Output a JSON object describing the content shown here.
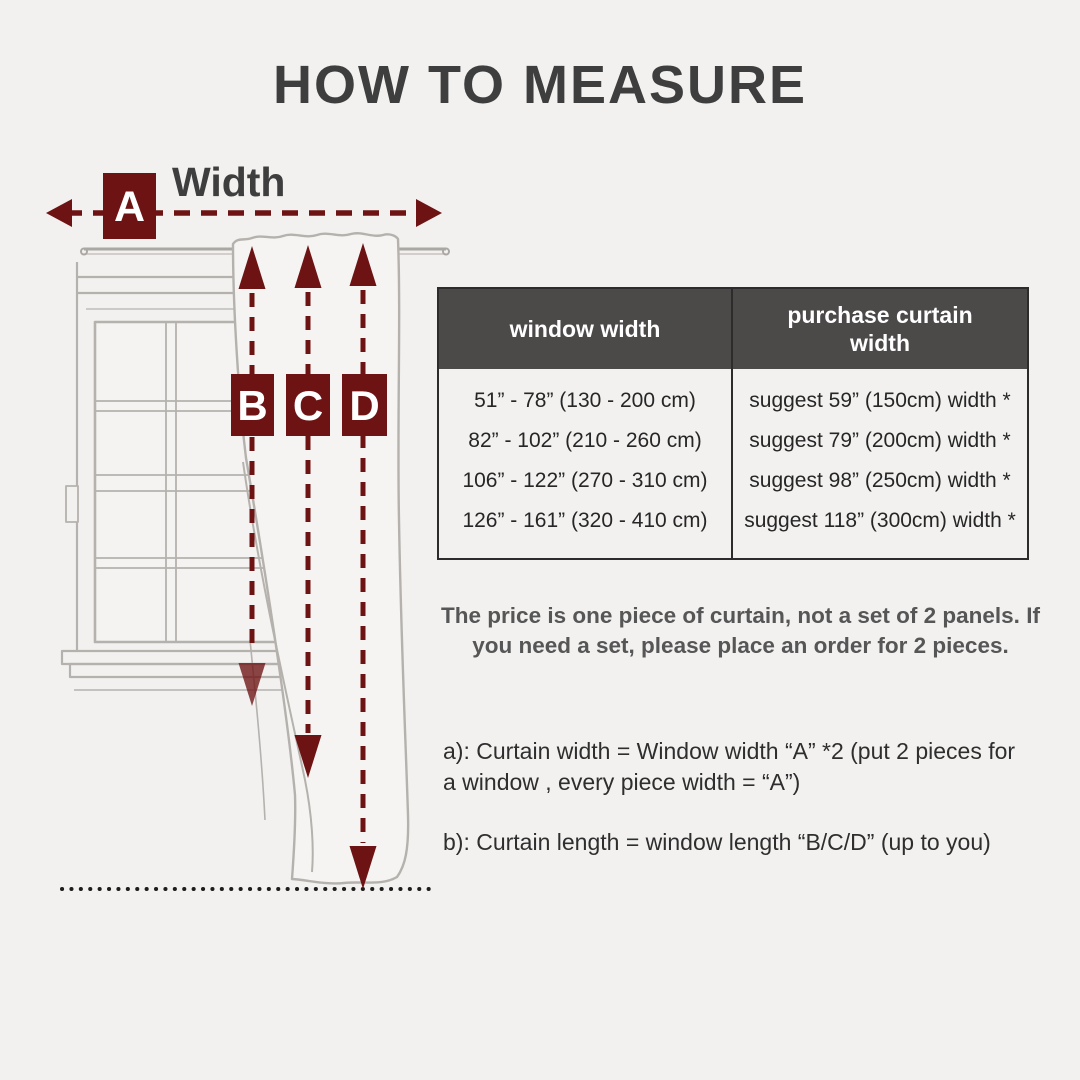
{
  "page": {
    "title": "HOW TO MEASURE"
  },
  "colors": {
    "background": "#f2f1f0",
    "accent_maroon": "#6e1313",
    "table_header_bg": "#4c4949",
    "sketch_gray": "#b5b2ae",
    "text_dark": "#3e3e3e"
  },
  "diagram": {
    "width_label": "Width",
    "marker_a": "A",
    "marker_b": "B",
    "marker_c": "C",
    "marker_d": "D"
  },
  "table": {
    "headers": [
      "window width",
      "purchase curtain width"
    ],
    "rows": [
      [
        "51” - 78” (130 - 200 cm)",
        "suggest 59” (150cm) width *"
      ],
      [
        "82” - 102” (210 - 260 cm)",
        "suggest 79” (200cm) width *"
      ],
      [
        "106” - 122” (270 - 310 cm)",
        "suggest 98” (250cm) width *"
      ],
      [
        "126” - 161” (320 - 410 cm)",
        "suggest 118” (300cm) width *"
      ]
    ]
  },
  "notes": {
    "price": "The price is one piece of curtain, not a set of 2 panels. If you need a set, please place an order for 2 pieces.",
    "a": "a): Curtain width = Window width “A” *2 (put 2 pieces for a window , every piece width = “A”)",
    "b": "b): Curtain length = window length “B/C/D” (up to you)"
  }
}
